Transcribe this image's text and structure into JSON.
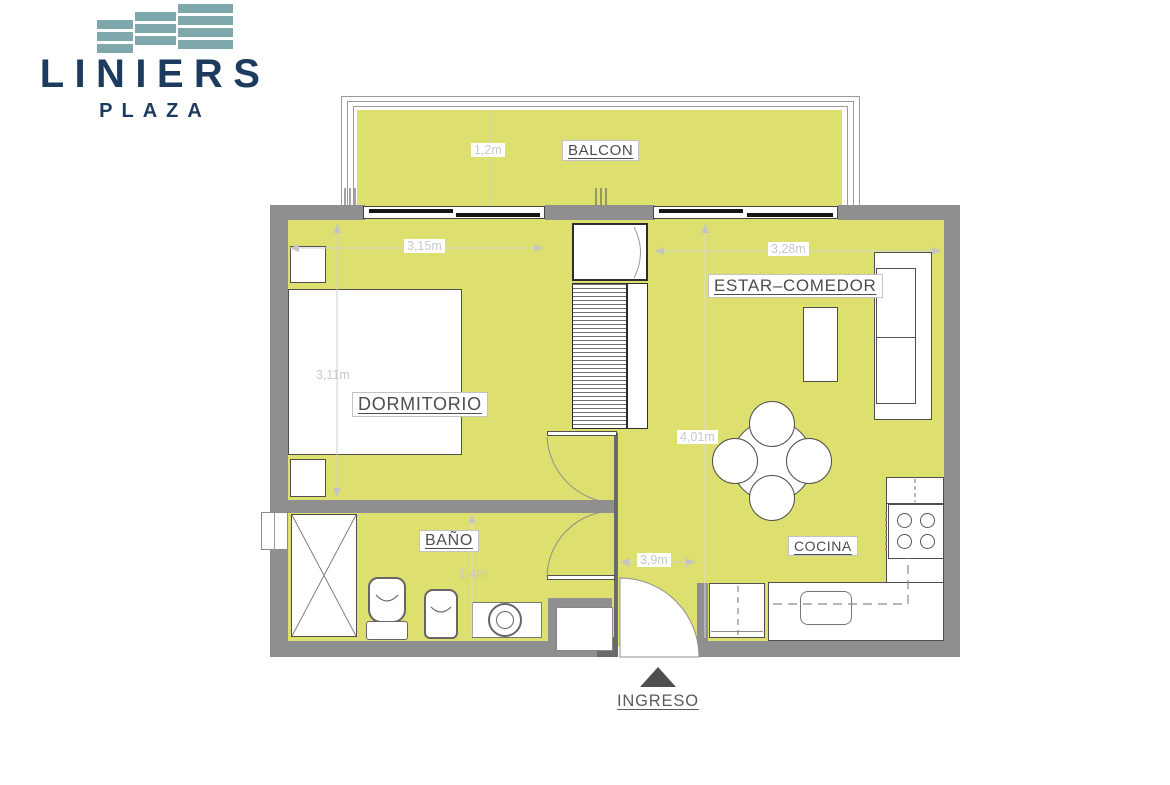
{
  "logo": {
    "brand": "LINIERS",
    "subtitle": "PLAZA",
    "brand_color": "#1d3a5f",
    "mark_color": "#7fa8ad"
  },
  "plan": {
    "floor_color": "#dde06e",
    "wall_color": "#8f8f8f",
    "labels": {
      "balcony": "BALCON",
      "bedroom": "DORMITORIO",
      "living": "ESTAR–COMEDOR",
      "bathroom": "BAÑO",
      "kitchen": "COCINA",
      "entrance": "INGRESO"
    },
    "dimensions": {
      "balcony_depth": "1,2m",
      "bedroom_width": "3,15m",
      "bedroom_depth": "3,11m",
      "living_width": "3,28m",
      "living_depth": "4,01m",
      "bathroom_depth": "1,4m",
      "entrance_width": "3,9m"
    }
  }
}
